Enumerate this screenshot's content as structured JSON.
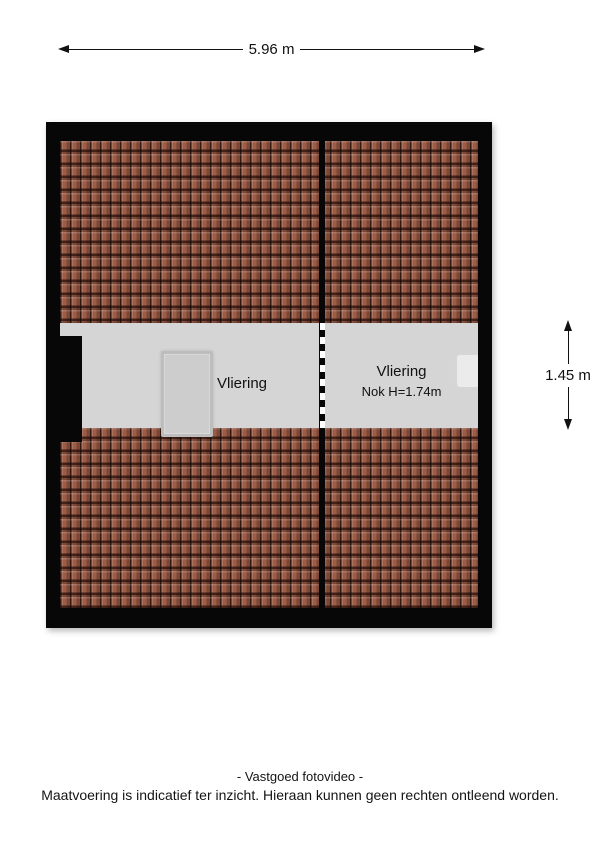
{
  "title": "Vliering floor plan",
  "dimensions": {
    "top": {
      "label": "5.96 m"
    },
    "right": {
      "label": "1.45 m"
    }
  },
  "floorplan": {
    "colors": {
      "wall": "#070707",
      "roof_tile": "#9d5c46",
      "roof_tile_gap": "#42251a",
      "floor": "#d5d5d5",
      "hatch_fill": "#cdcdcd",
      "niche_fill": "#ebebeb",
      "divider_dash": "#ffffff"
    },
    "rooms": [
      {
        "name": "vliering-left",
        "label": "Vliering"
      },
      {
        "name": "vliering-right",
        "label": "Vliering",
        "sublabel": "Nok H=1.74m"
      }
    ]
  },
  "footer": {
    "line1": "- Vastgoed fotovideo -",
    "line2": "Maatvoering is indicatief ter inzicht. Hieraan kunnen geen rechten ontleend worden."
  }
}
